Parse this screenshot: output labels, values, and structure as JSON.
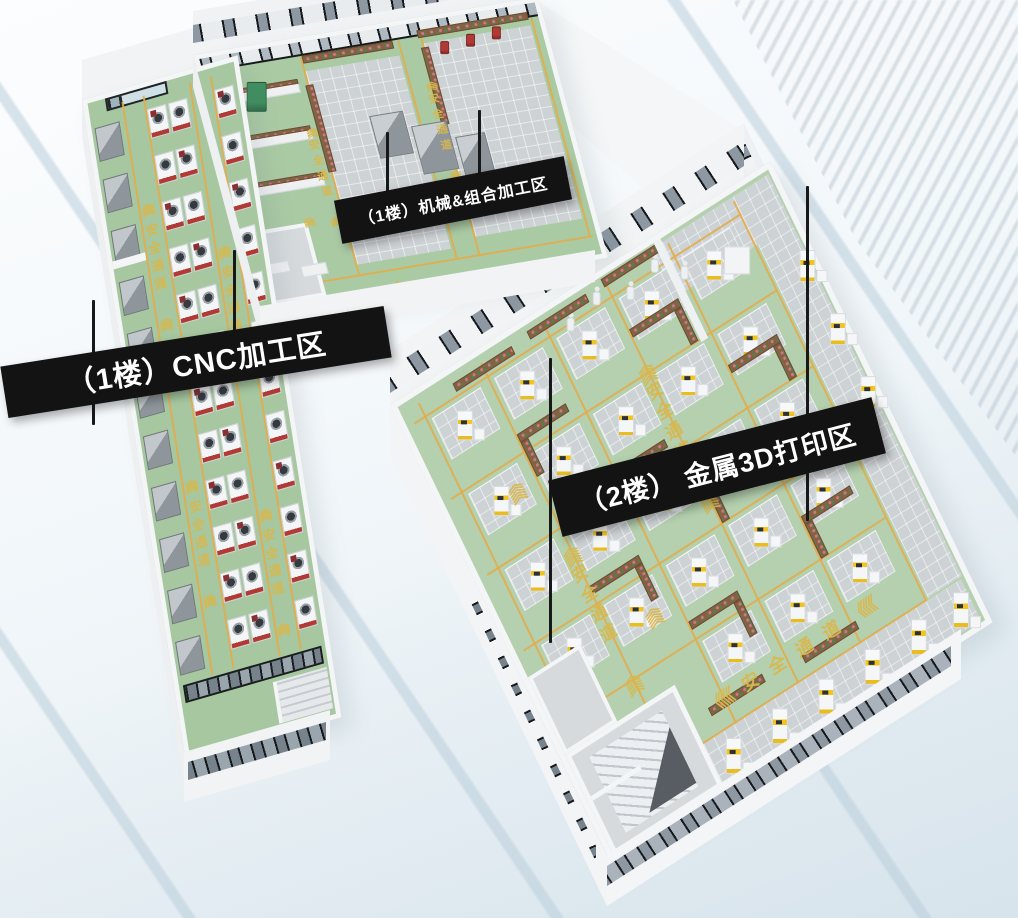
{
  "scene_title": "factory-3d-floorplan",
  "banners": {
    "cnc": "（1楼）CNC加工区",
    "mech": "（1楼）机械&组合加工区",
    "print3d": "（2楼） 金属3D打印区"
  },
  "floor_marking": {
    "text": "安全通道",
    "chevron": "《"
  },
  "palette": {
    "floor_green_cnc": "#a6c7a0",
    "floor_green_mech": "#aacaa4",
    "floor_green_3d": "#b4d0ae",
    "tile_gray": "#cdd2d5",
    "aisle_yellow": "#e2ac4c",
    "marking_yellow": "#d8b84e",
    "wall_white": "#f2f4f5",
    "window_dark": "#17191c",
    "banner_black": "#131313",
    "banner_text": "#ffffff",
    "machine_white": "#f3f5f6",
    "machine_red": "#b23a35",
    "machine_gray": "#8e959b",
    "printer_yellow": "#f2c41d",
    "planter_brown": "#8a5f41",
    "plant_green": "#527f4e",
    "flower_pink": "#d4748a",
    "mech_blue": "#5a79c8",
    "mech_green": "#3f8f5f"
  },
  "equipment": {
    "cnc": {
      "white_machine_columns": 3,
      "machines_per_column": 12,
      "gray_machines": 11
    },
    "print3d": {
      "printer_rows": 5,
      "printer_cols": 5,
      "wall_printers": 6,
      "side_printers": 3,
      "robots": 5
    },
    "mech": {
      "cnc_centers": 3,
      "red_units": 3,
      "blue_units": 1,
      "green_units": 1
    }
  }
}
